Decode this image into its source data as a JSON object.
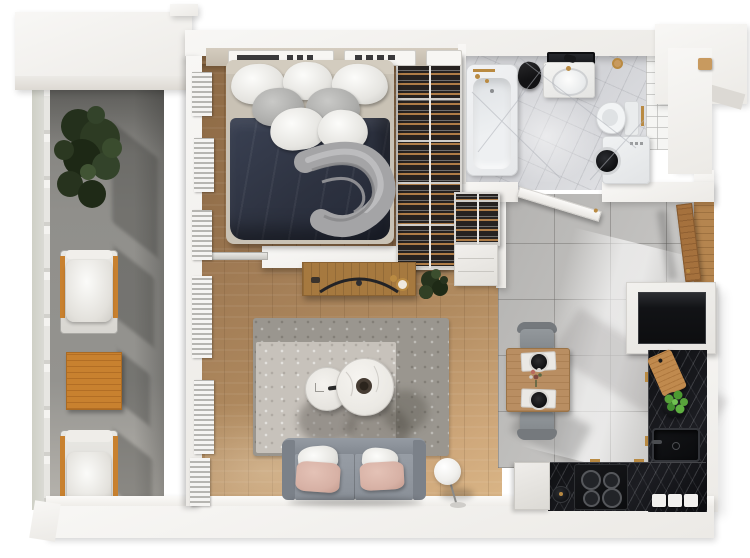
{
  "scene": {
    "type": "3d-apartment-floor-plan",
    "view": "top-down-render",
    "canvas": {
      "width": 750,
      "height": 558,
      "background": "#ffffff"
    },
    "rooms": [
      "balcony",
      "bedroom",
      "bathroom",
      "hallway",
      "living-room",
      "kitchen"
    ]
  },
  "colors": {
    "wall": "#f4f3f0",
    "wallFace": "#ddd9d3",
    "woodA": "#8d6a45",
    "woodB": "#cfa87b",
    "balcony": "#908f8b",
    "navy": "#2d3240",
    "sofa": "#8a9098",
    "blush": "#d7b1a5",
    "rugA": "#9a968f",
    "rugB": "#c7c2bb",
    "counter": "#1c1d22",
    "bathFloor": "#d2d3d7",
    "tile": "#c0bfbd",
    "orange": "#c8812f",
    "brass": "#b98a42",
    "closet": "#262220",
    "plant": "#2e3a26",
    "herb": "#5aa63d",
    "tableWood": "#b98e62",
    "door": "#a5713d",
    "black": "#0d0e10",
    "cushion": "#f2f1ee"
  },
  "objects": {
    "balcony": [
      "potted-plant",
      "lounge-chair",
      "orange-side-table",
      "lounge-chair",
      "railing"
    ],
    "bedroom": [
      "double-bed",
      "white-pillows",
      "gray-pillows",
      "navy-duvet",
      "gray-throw-blanket",
      "open-wardrobe-with-clothes",
      "radiator-panels",
      "windows"
    ],
    "bathroom": [
      "bathtub",
      "brass-faucet",
      "black-towel",
      "vanity-sink",
      "black-framed-mirror",
      "toilet",
      "washing-machine",
      "subway-tile-wall",
      "marble-floor",
      "door-leaf"
    ],
    "hallway": [
      "entry-door-wood",
      "shoe-wardrobe",
      "white-cabinet",
      "gray-floor-tiles"
    ],
    "living_room": [
      "tv-console",
      "curved-tv",
      "potted-plant",
      "two-tone-area-rug",
      "round-coffee-table-small",
      "round-coffee-table-large",
      "decor-bowl",
      "gray-sofa",
      "white-cushions",
      "blush-cushions",
      "floor-lamp-globe"
    ],
    "kitchen": [
      "dining-table",
      "two-gray-chairs",
      "place-settings-black-plates",
      "flower-vase",
      "dark-marble-counter-L",
      "black-sink",
      "induction-cooktop",
      "cutting-board",
      "herb-pot",
      "built-in-black-appliance",
      "white-canisters",
      "black-kettle",
      "duct-shaft"
    ]
  }
}
